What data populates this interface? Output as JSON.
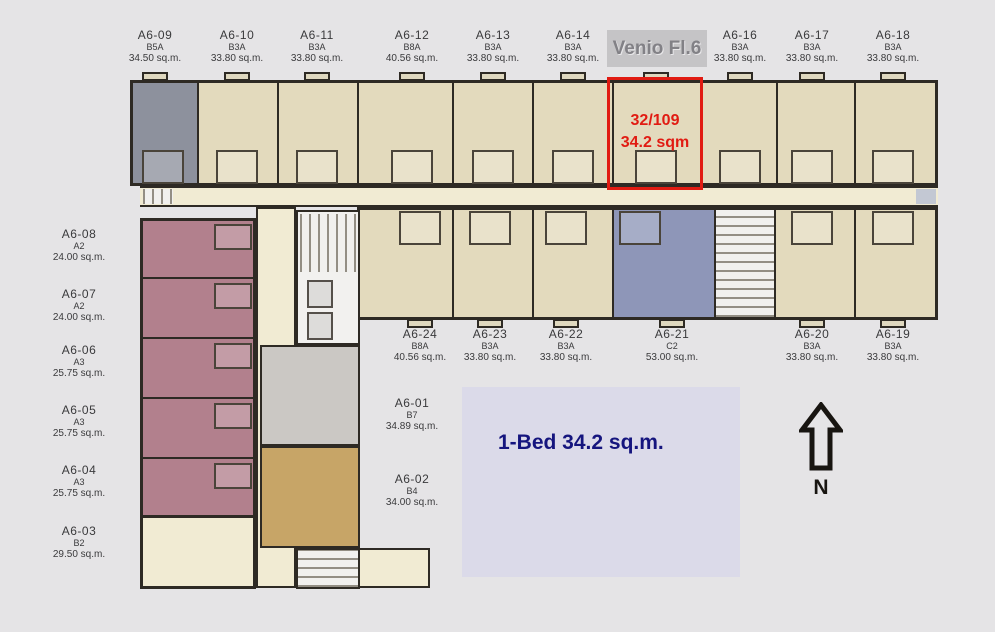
{
  "floorplan": {
    "title": "Venio Fl.6",
    "highlight": {
      "unit": "32/109",
      "area": "34.2 sqm"
    },
    "caption": "1-Bed 34.2 sq.m.",
    "compass": "N",
    "colors": {
      "highlight_red": "#e11b12",
      "caption_text": "#15157e",
      "caption_bg": "#dbdae9",
      "title_bg": "#c5c4c6",
      "title_text": "#828186",
      "unit_beige": "#e3dabd",
      "unit_gray": "#8d919d",
      "unit_pink": "#b2808d",
      "unit_blue": "#8e96b8",
      "unit_gold": "#c7a567",
      "unit_ltgray": "#cbc8c4",
      "corridor_cream": "#f1ebd3",
      "wall": "#2e2a24"
    },
    "top_units": [
      {
        "id": "A6-09",
        "type": "B5A",
        "area": "34.50 sq.m."
      },
      {
        "id": "A6-10",
        "type": "B3A",
        "area": "33.80 sq.m."
      },
      {
        "id": "A6-11",
        "type": "B3A",
        "area": "33.80 sq.m."
      },
      {
        "id": "A6-12",
        "type": "B8A",
        "area": "40.56 sq.m."
      },
      {
        "id": "A6-13",
        "type": "B3A",
        "area": "33.80 sq.m."
      },
      {
        "id": "A6-14",
        "type": "B3A",
        "area": "33.80 sq.m."
      },
      {
        "id": "A6-16",
        "type": "B3A",
        "area": "33.80 sq.m."
      },
      {
        "id": "A6-17",
        "type": "B3A",
        "area": "33.80 sq.m."
      },
      {
        "id": "A6-18",
        "type": "B3A",
        "area": "33.80 sq.m."
      }
    ],
    "bottom_units": [
      {
        "id": "A6-24",
        "type": "B8A",
        "area": "40.56 sq.m."
      },
      {
        "id": "A6-23",
        "type": "B3A",
        "area": "33.80 sq.m."
      },
      {
        "id": "A6-22",
        "type": "B3A",
        "area": "33.80 sq.m."
      },
      {
        "id": "A6-21",
        "type": "C2",
        "area": "53.00 sq.m."
      },
      {
        "id": "A6-20",
        "type": "B3A",
        "area": "33.80 sq.m."
      },
      {
        "id": "A6-19",
        "type": "B3A",
        "area": "33.80 sq.m."
      }
    ],
    "left_units": [
      {
        "id": "A6-08",
        "type": "A2",
        "area": "24.00 sq.m."
      },
      {
        "id": "A6-07",
        "type": "A2",
        "area": "24.00 sq.m."
      },
      {
        "id": "A6-06",
        "type": "A3",
        "area": "25.75 sq.m."
      },
      {
        "id": "A6-05",
        "type": "A3",
        "area": "25.75 sq.m."
      },
      {
        "id": "A6-04",
        "type": "A3",
        "area": "25.75 sq.m."
      },
      {
        "id": "A6-03",
        "type": "B2",
        "area": "29.50 sq.m."
      }
    ],
    "core_units": [
      {
        "id": "A6-01",
        "type": "B7",
        "area": "34.89 sq.m."
      },
      {
        "id": "A6-02",
        "type": "B4",
        "area": "34.00 sq.m."
      }
    ]
  }
}
